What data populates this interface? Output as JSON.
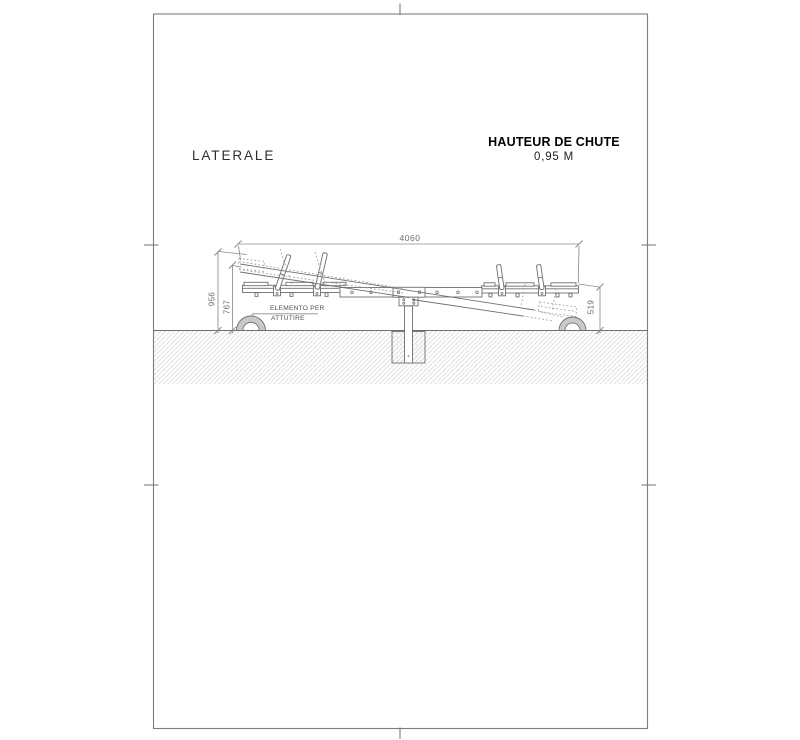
{
  "sheet": {
    "view_title": "LATERALE",
    "fall_height_title": "HAUTEUR DE CHUTE",
    "fall_height_value": "0,95 M"
  },
  "dimensions": {
    "overall_length": "4060",
    "height_max": "956",
    "height_beam_end": "767",
    "height_right_end": "519"
  },
  "annotations": {
    "damper_label_line1": "ELEMENTO PER",
    "damper_label_line2": "ATTUTIRE"
  },
  "colors": {
    "line": "#6f6f6f",
    "dim": "#8c8c8c",
    "ghost": "#9d9d9d",
    "frame": "#7d7d7d",
    "hatch": "#d7d7d7",
    "tire_fill": "#c9c9c9",
    "stipple": "#b8b8b8",
    "title_text": "#2e2e2e",
    "bold_text": "#000000",
    "dim_text": "#6b6b6b"
  }
}
